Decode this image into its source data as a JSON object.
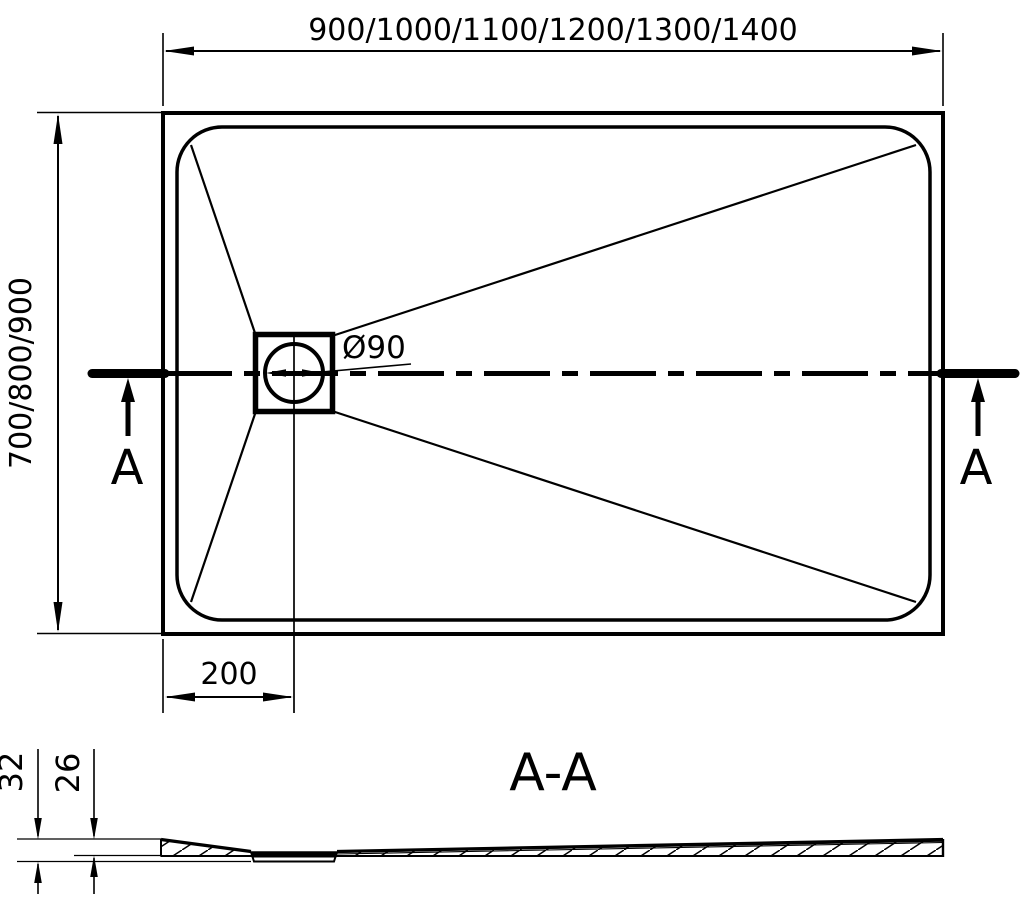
{
  "top_view": {
    "width_dimension_label": "900/1000/1100/1200/1300/1400",
    "depth_dimension_label": "700/800/900",
    "drain_diameter_label": "Ø90",
    "drain_offset_label": "200",
    "section_marker_left_label": "A",
    "section_marker_right_label": "A"
  },
  "section_view": {
    "title": "A-A",
    "overall_height_label": "32",
    "base_height_label": "26"
  },
  "colors": {
    "ink": "#000000",
    "background": "#ffffff"
  }
}
